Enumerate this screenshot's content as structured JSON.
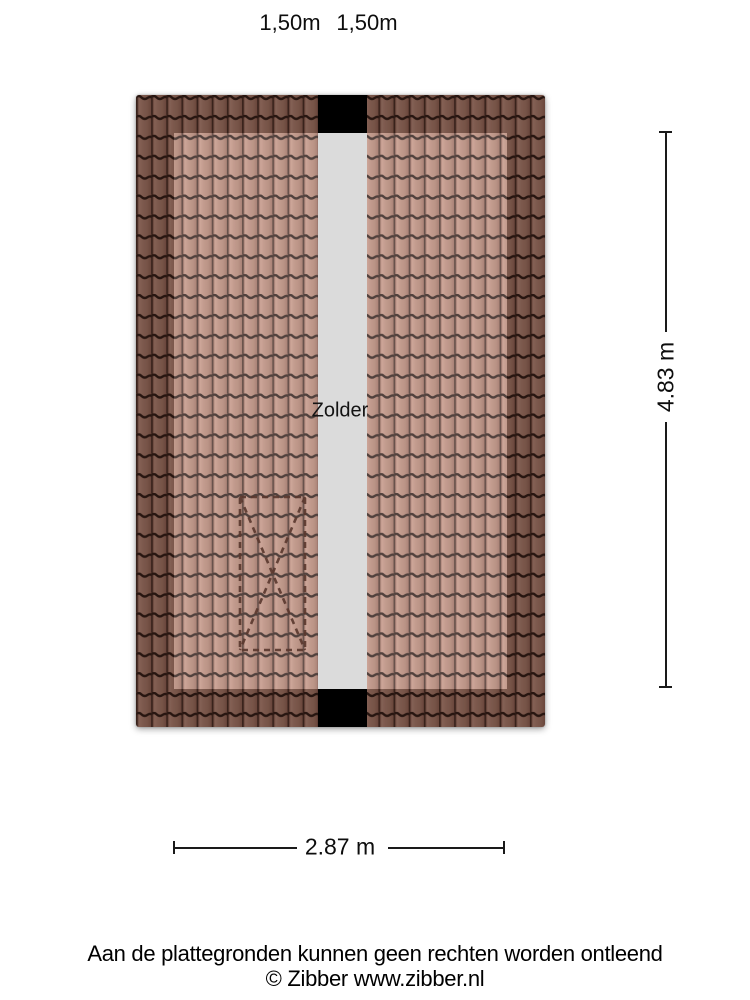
{
  "floorplan": {
    "room_label": "Zolder",
    "top_dimension_labels": [
      "1,50m",
      "1,50m"
    ],
    "width_dimension": "2.87 m",
    "height_dimension": "4.83 m"
  },
  "footer": {
    "disclaimer": "Aan de plattegronden kunnen geen rechten worden ontleend",
    "copyright": "© Zibber www.zibber.nl"
  },
  "colors": {
    "tile_inner": "#b28174",
    "tile_outer": "#7a5146",
    "tile_joint_line": "#2e1b16",
    "ridge_strip": "#dbdbdb",
    "ridge_block": "#000000",
    "stairs_dash": "#5a382e",
    "dimension_line": "#1a1a1a"
  }
}
